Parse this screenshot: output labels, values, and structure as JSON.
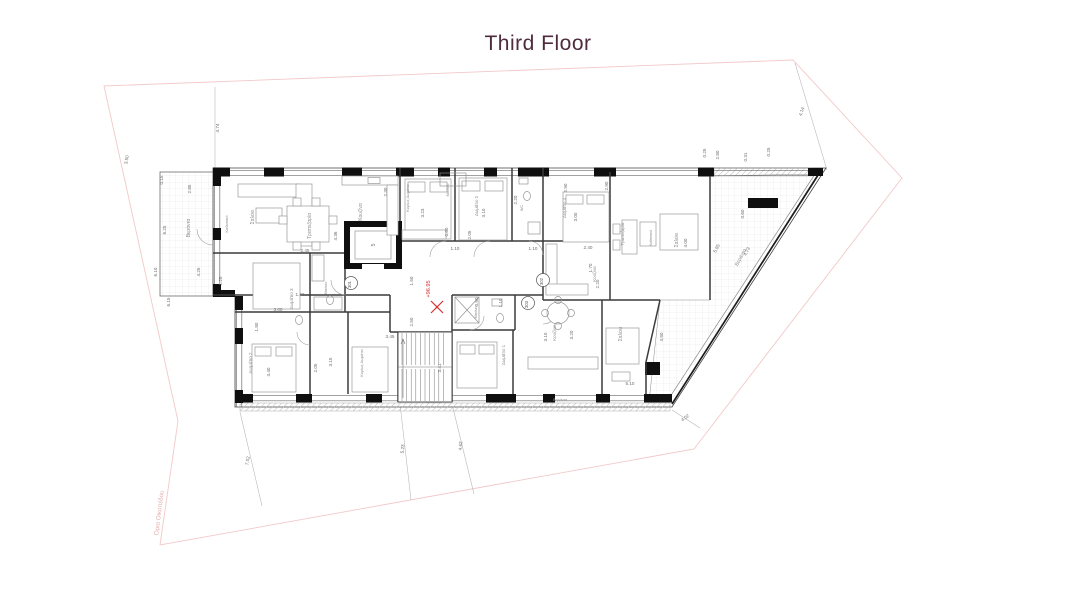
{
  "title": "Third Floor",
  "colors": {
    "title": "#4e2b3d",
    "walls": "#0f0f0f",
    "interior_lines": "#3a3a3a",
    "dimension_text": "#6f6f6f",
    "plot_boundary": "#f2c9c9",
    "boundary_text": "#e6b0b0",
    "level_accent": "#d63030"
  },
  "plan": {
    "level_marker": {
      "text": "+96.95"
    },
    "boundary_label": {
      "text": "Όρια Οικοπέδου"
    },
    "elevator_label": "5",
    "apartment_markers": [
      {
        "label": "301",
        "x": 351,
        "y": 283
      },
      {
        "label": "302",
        "x": 543,
        "y": 280
      },
      {
        "label": "303",
        "x": 528,
        "y": 303
      }
    ],
    "rooms": [
      {
        "label": "Βεράντα",
        "x": 190,
        "y": 228,
        "r": -90,
        "fs": 5
      },
      {
        "label": "Καθιστικό",
        "x": 228,
        "y": 224,
        "r": -90,
        "fs": 4
      },
      {
        "label": "Σαλόνι",
        "x": 254,
        "y": 217,
        "r": -90,
        "fs": 5
      },
      {
        "label": "Τραπεζαρία",
        "x": 311,
        "y": 226,
        "r": -90,
        "fs": 5
      },
      {
        "label": "Κουζίνα",
        "x": 362,
        "y": 212,
        "r": -90,
        "fs": 5
      },
      {
        "label": "Δωμάτιο 3",
        "x": 293,
        "y": 299,
        "r": -90,
        "fs": 4.6
      },
      {
        "label": "Μπάνιο",
        "x": 327,
        "y": 288,
        "r": -90,
        "fs": 3.8
      },
      {
        "label": "Δωμάτιο 2",
        "x": 252,
        "y": 363,
        "r": -90,
        "fs": 4.6
      },
      {
        "label": "Κυρίως Δωμάτιο",
        "x": 363,
        "y": 363,
        "r": -90,
        "fs": 3.8
      },
      {
        "label": "Κυρίως Δωμάτιο",
        "x": 409,
        "y": 198,
        "r": -90,
        "fs": 3.8
      },
      {
        "label": "Δωμάτιο 2",
        "x": 478,
        "y": 206,
        "r": -90,
        "fs": 4.4
      },
      {
        "label": "Μπάνιο",
        "x": 449,
        "y": 190,
        "r": -90,
        "fs": 3.8
      },
      {
        "label": "WC",
        "x": 523,
        "y": 208,
        "r": -90,
        "fs": 3.8
      },
      {
        "label": "Δωμάτιο 3",
        "x": 566,
        "y": 208,
        "r": -90,
        "fs": 4.4
      },
      {
        "label": "Κουζίνα",
        "x": 596,
        "y": 274,
        "r": -90,
        "fs": 4.4
      },
      {
        "label": "Τραπεζαρία",
        "x": 624,
        "y": 234,
        "r": -90,
        "fs": 4.4
      },
      {
        "label": "Καθιστικό",
        "x": 652,
        "y": 238,
        "r": -90,
        "fs": 3.8
      },
      {
        "label": "Σαλόνι",
        "x": 678,
        "y": 240,
        "r": -90,
        "fs": 5
      },
      {
        "label": "Βεράντα",
        "x": 742,
        "y": 258,
        "r": -62,
        "fs": 5
      },
      {
        "label": "Μπάνιο",
        "x": 477,
        "y": 312,
        "r": -90,
        "fs": 3.8
      },
      {
        "label": "Δωμάτιο 1",
        "x": 505,
        "y": 355,
        "r": -90,
        "fs": 4.4
      },
      {
        "label": "Κουζίνα",
        "x": 556,
        "y": 333,
        "r": -90,
        "fs": 4.4
      },
      {
        "label": "Σαλόνι",
        "x": 622,
        "y": 334,
        "r": -90,
        "fs": 5
      },
      {
        "label": "Βεράντα",
        "x": 560,
        "y": 401,
        "r": 0,
        "fs": 3.8
      }
    ],
    "dimensions": [
      {
        "t": "4.74",
        "x": 219,
        "y": 128,
        "r": -90
      },
      {
        "t": "4.14",
        "x": 803,
        "y": 112,
        "r": -72
      },
      {
        "t": "3.50",
        "x": 128,
        "y": 160,
        "r": -80
      },
      {
        "t": "0.15",
        "x": 163,
        "y": 180,
        "r": -90
      },
      {
        "t": "2.85",
        "x": 191,
        "y": 189,
        "r": -90
      },
      {
        "t": "6.25",
        "x": 166,
        "y": 230,
        "r": -90
      },
      {
        "t": "6.10",
        "x": 157,
        "y": 272,
        "r": -90
      },
      {
        "t": "4.25",
        "x": 200,
        "y": 272,
        "r": -90
      },
      {
        "t": "1.25",
        "x": 222,
        "y": 281,
        "r": -90
      },
      {
        "t": "6.15",
        "x": 170,
        "y": 302,
        "r": -90
      },
      {
        "t": "2.45",
        "x": 305,
        "y": 252,
        "r": 0
      },
      {
        "t": "4.36",
        "x": 337,
        "y": 236,
        "r": -90
      },
      {
        "t": "2.30",
        "x": 387,
        "y": 192,
        "r": -90
      },
      {
        "t": "3.23",
        "x": 424,
        "y": 213,
        "r": -90
      },
      {
        "t": "3.10",
        "x": 485,
        "y": 213,
        "r": -90
      },
      {
        "t": "2.20",
        "x": 517,
        "y": 200,
        "r": -90
      },
      {
        "t": "0.80",
        "x": 448,
        "y": 232,
        "r": -90
      },
      {
        "t": "2.05",
        "x": 471,
        "y": 235,
        "r": -90
      },
      {
        "t": "1.10",
        "x": 455,
        "y": 250,
        "r": 0
      },
      {
        "t": "1.10",
        "x": 533,
        "y": 250,
        "r": 0
      },
      {
        "t": "2.90",
        "x": 567,
        "y": 188,
        "r": -90
      },
      {
        "t": "2.90",
        "x": 608,
        "y": 186,
        "r": -90
      },
      {
        "t": "3.00",
        "x": 577,
        "y": 217,
        "r": -90
      },
      {
        "t": "2.40",
        "x": 588,
        "y": 249,
        "r": 0
      },
      {
        "t": "1.70",
        "x": 592,
        "y": 268,
        "r": -90
      },
      {
        "t": "2.20",
        "x": 599,
        "y": 284,
        "r": -90
      },
      {
        "t": "4.00",
        "x": 687,
        "y": 243,
        "r": -90
      },
      {
        "t": "5.85",
        "x": 718,
        "y": 249,
        "r": -62
      },
      {
        "t": "4.73",
        "x": 748,
        "y": 252,
        "r": -62
      },
      {
        "t": "0.60",
        "x": 744,
        "y": 214,
        "r": -90
      },
      {
        "t": "0.25",
        "x": 706,
        "y": 153,
        "r": -90
      },
      {
        "t": "2.80",
        "x": 719,
        "y": 155,
        "r": -90
      },
      {
        "t": "0.31",
        "x": 747,
        "y": 157,
        "r": -90
      },
      {
        "t": "0.25",
        "x": 770,
        "y": 152,
        "r": -90
      },
      {
        "t": "1.50",
        "x": 413,
        "y": 281,
        "r": -90
      },
      {
        "t": "2.50",
        "x": 413,
        "y": 322,
        "r": -90
      },
      {
        "t": "1.40",
        "x": 300,
        "y": 296,
        "r": 0
      },
      {
        "t": "3.00",
        "x": 278,
        "y": 311,
        "r": 0
      },
      {
        "t": "1.80",
        "x": 258,
        "y": 327,
        "r": -90
      },
      {
        "t": "3.40",
        "x": 270,
        "y": 372,
        "r": -90
      },
      {
        "t": "2.05",
        "x": 317,
        "y": 368,
        "r": -90
      },
      {
        "t": "3.15",
        "x": 332,
        "y": 362,
        "r": -90
      },
      {
        "t": "3.45",
        "x": 390,
        "y": 338,
        "r": 0
      },
      {
        "t": "3.41",
        "x": 441,
        "y": 368,
        "r": -90
      },
      {
        "t": "0.90",
        "x": 478,
        "y": 302,
        "r": -90
      },
      {
        "t": "1.10",
        "x": 502,
        "y": 303,
        "r": -90
      },
      {
        "t": "3.10",
        "x": 547,
        "y": 337,
        "r": -90
      },
      {
        "t": "3.20",
        "x": 573,
        "y": 335,
        "r": -90
      },
      {
        "t": "4.80",
        "x": 663,
        "y": 337,
        "r": -90
      },
      {
        "t": "5.10",
        "x": 630,
        "y": 385,
        "r": 0
      },
      {
        "t": "7.02",
        "x": 249,
        "y": 461,
        "r": -80
      },
      {
        "t": "5.23",
        "x": 404,
        "y": 449,
        "r": -85
      },
      {
        "t": "4.62",
        "x": 462,
        "y": 446,
        "r": -85
      },
      {
        "t": "4.02",
        "x": 686,
        "y": 419,
        "r": -35
      }
    ]
  }
}
